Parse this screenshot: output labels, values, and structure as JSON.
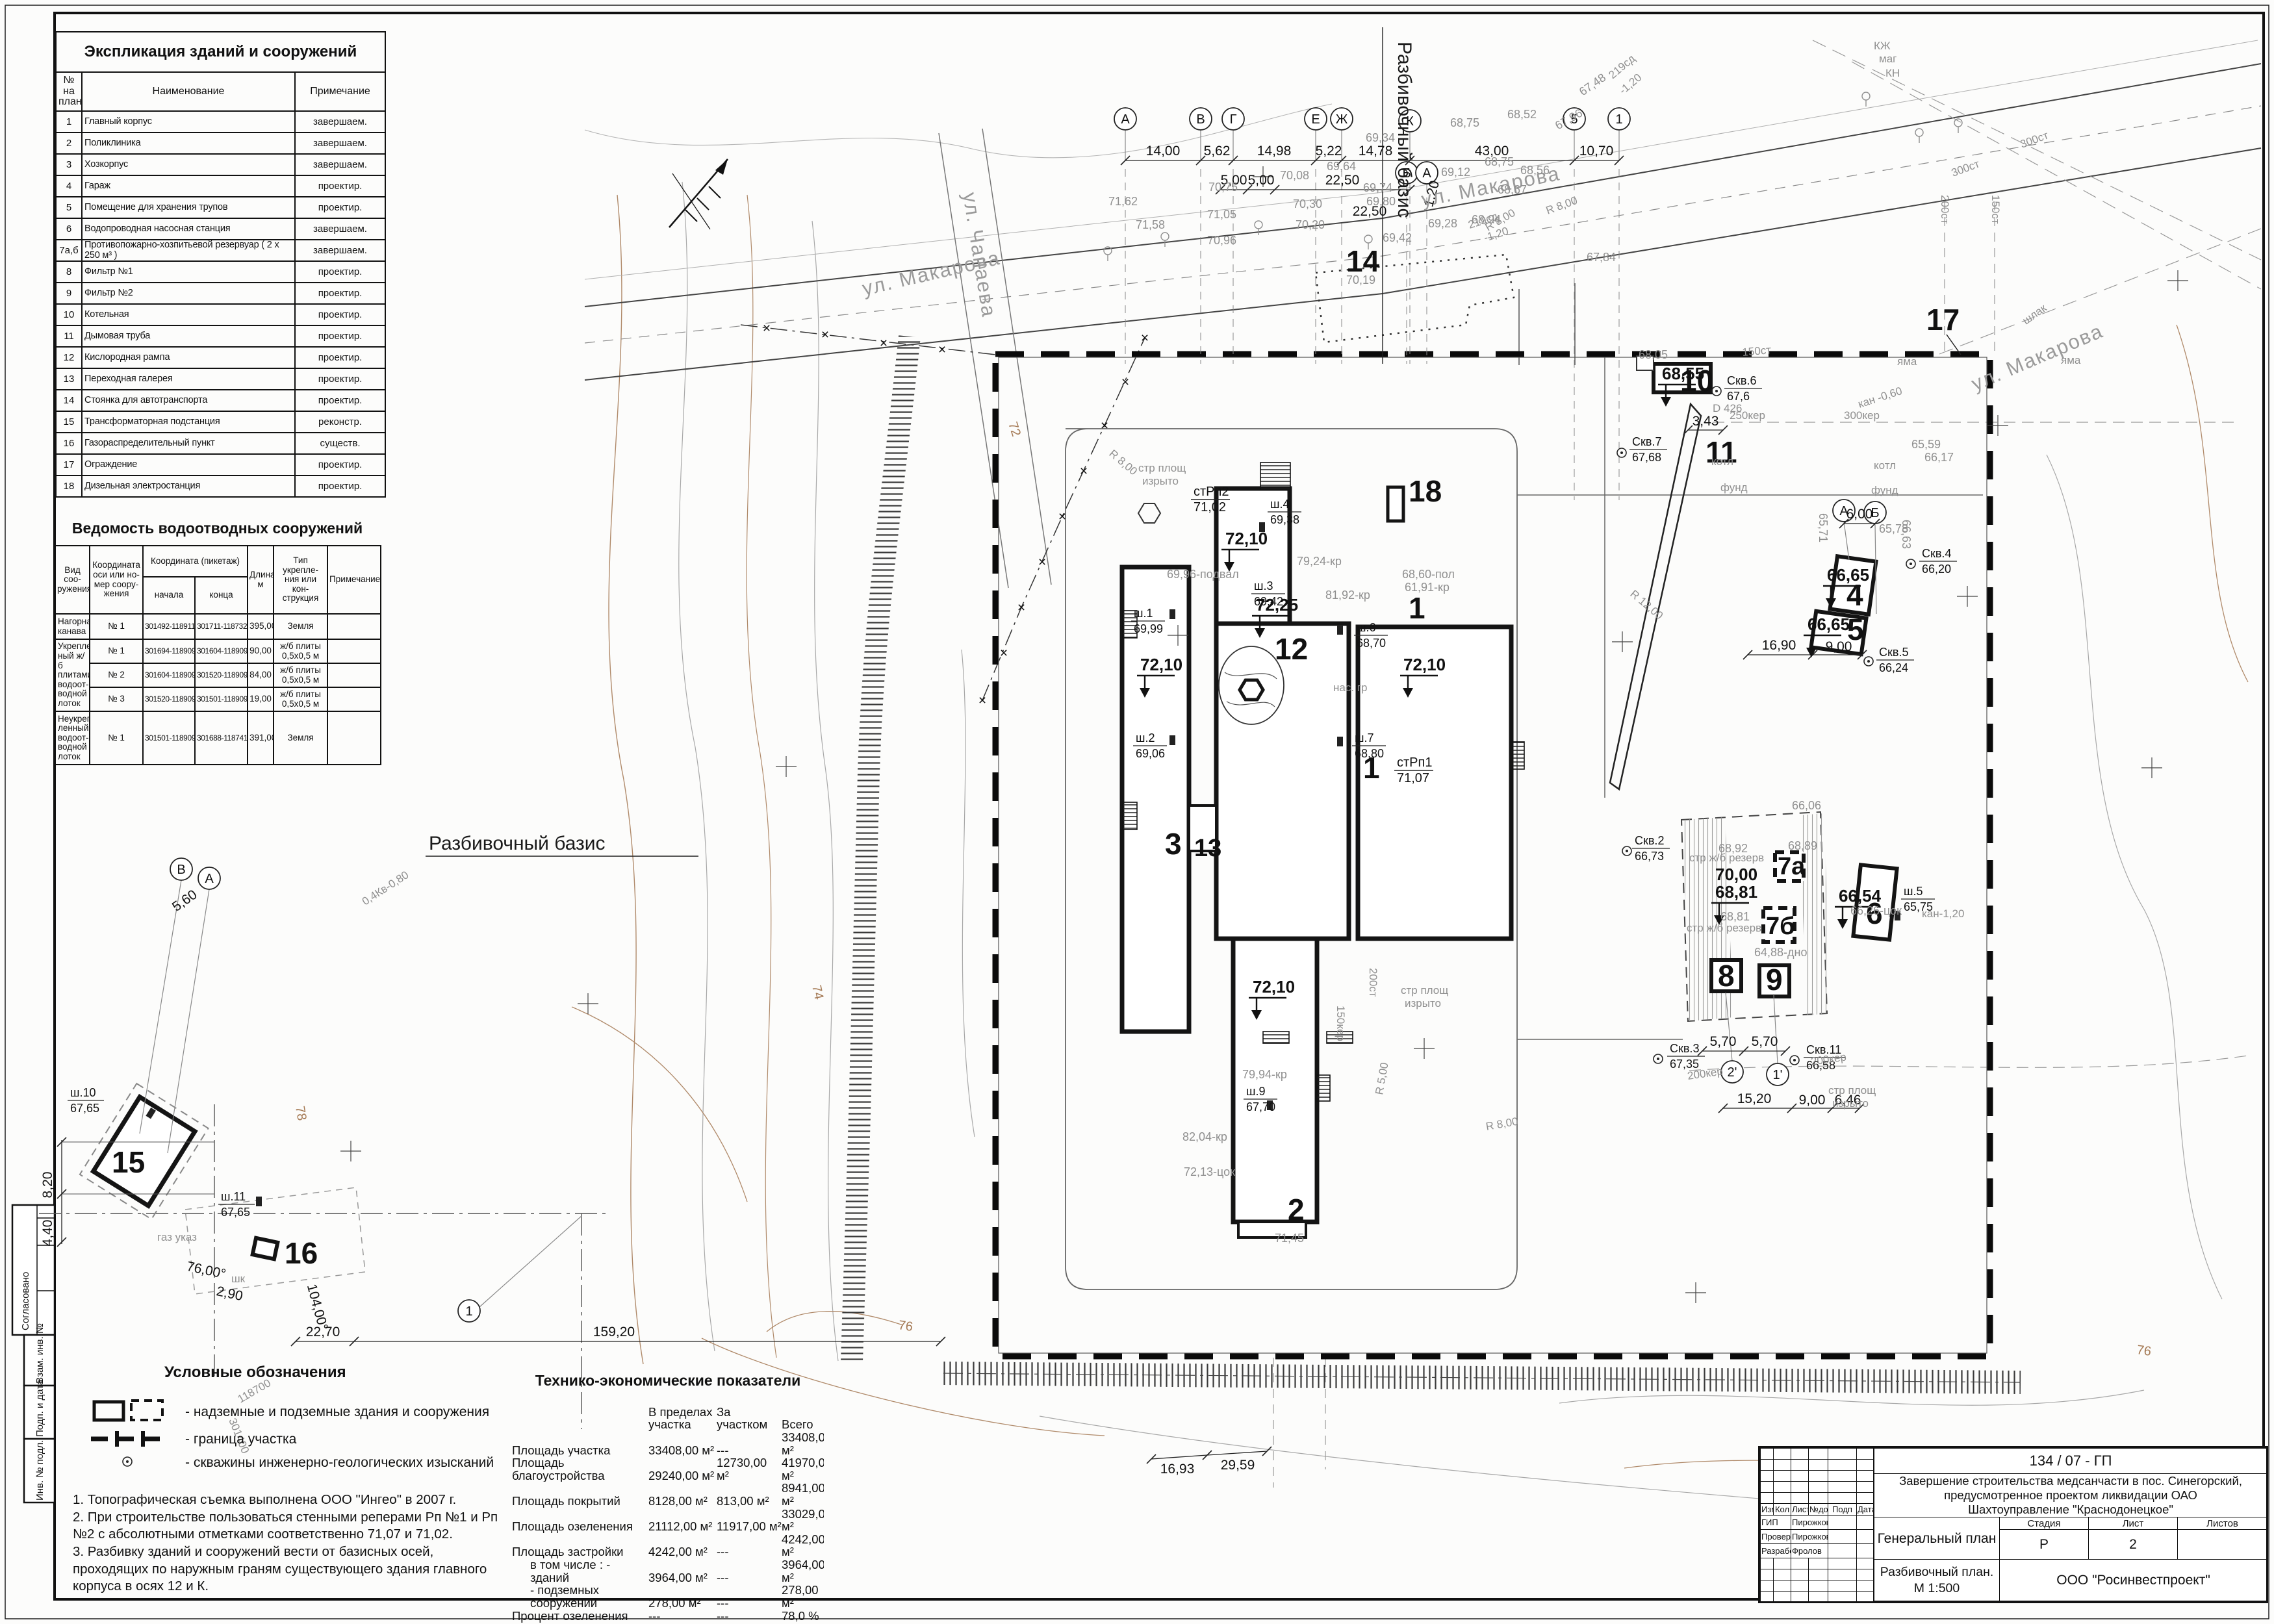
{
  "sheet": {
    "explication": {
      "title": "Экспликация зданий и сооружений",
      "columns": {
        "num": "№ на\nплане",
        "name": "Наименование",
        "note": "Примечание"
      },
      "rows": [
        {
          "n": "1",
          "name": "Главный корпус",
          "note": "завершаем."
        },
        {
          "n": "2",
          "name": "Поликлиника",
          "note": "завершаем."
        },
        {
          "n": "3",
          "name": "Хозкорпус",
          "note": "завершаем."
        },
        {
          "n": "4",
          "name": "Гараж",
          "note": "проектир."
        },
        {
          "n": "5",
          "name": "Помещение для хранения трупов",
          "note": "проектир."
        },
        {
          "n": "6",
          "name": "Водопроводная насосная станция",
          "note": "завершаем."
        },
        {
          "n": "7а,б",
          "name": "Противопожарно-хозпитьевой резервуар ( 2 х 250 м³ )",
          "note": "завершаем."
        },
        {
          "n": "8",
          "name": "Фильтр №1",
          "note": "проектир."
        },
        {
          "n": "9",
          "name": "Фильтр №2",
          "note": "проектир."
        },
        {
          "n": "10",
          "name": "Котельная",
          "note": "проектир."
        },
        {
          "n": "11",
          "name": "Дымовая труба",
          "note": "проектир."
        },
        {
          "n": "12",
          "name": "Кислородная рампа",
          "note": "проектир."
        },
        {
          "n": "13",
          "name": "Переходная галерея",
          "note": "проектир."
        },
        {
          "n": "14",
          "name": "Стоянка для автотранспорта",
          "note": "проектир."
        },
        {
          "n": "15",
          "name": "Трансформаторная подстанция",
          "note": "реконстр."
        },
        {
          "n": "16",
          "name": "Газораспределительный пункт",
          "note": "существ."
        },
        {
          "n": "17",
          "name": "Ограждение",
          "note": "проектир."
        },
        {
          "n": "18",
          "name": "Дизельная электростанция",
          "note": "проектир."
        }
      ]
    },
    "drainage": {
      "title": "Ведомость водоотводных сооружений",
      "columns": {
        "kind": "Вид соо-\nружения",
        "axis": "Координата\nоси или но-\nмер соору-\nжения",
        "coord": "Координата (пикетаж)",
        "start": "начала",
        "end": "конца",
        "len": "Длина,\nм",
        "type": "Тип укрепле-\nния или кон-\nструкция",
        "note": "Примечание"
      },
      "rows": [
        {
          "kind": "Нагорная\nканава",
          "axis": "№ 1",
          "start": "301492-118911",
          "end": "301711-118732",
          "len": "395,00",
          "type": "Земля",
          "note": ""
        },
        {
          "kind": "Укреплен-\nный ж/б\nплитами\nводоот-\nводной\nлоток",
          "axis": "№ 1",
          "start": "301694-118909",
          "end": "301604-118909",
          "len": "90,00",
          "type": "ж/б плиты\n0,5х0,5 м",
          "note": ""
        },
        {
          "axis": "№ 2",
          "start": "301604-118909",
          "end": "301520-118909",
          "len": "84,00",
          "type": "ж/б плиты\n0,5х0,5 м",
          "note": ""
        },
        {
          "axis": "№ 3",
          "start": "301520-118909",
          "end": "301501-118909",
          "len": "19,00",
          "type": "ж/б плиты\n0,5х0,5 м",
          "note": ""
        },
        {
          "kind": "Неукреп-\nленный\nводоот-\nводной\nлоток",
          "axis": "№ 1",
          "start": "301501-118909",
          "end": "301688-118741",
          "len": "391,00",
          "type": "Земля",
          "note": ""
        }
      ]
    },
    "legend": {
      "title": "Условные обозначения",
      "items": [
        "-  надземные и подземные здания и сооружения",
        "-  граница участка",
        "-  скважины инженерно-геологических изысканий"
      ]
    },
    "notes": {
      "n1": "1. Топографическая съемка выполнена ООО \"Ингео\" в 2007 г.",
      "n2": "2. При строительстве пользоваться стенными реперами Рп №1 и Рп №2 с абсолютными отметками соответственно 71,07 и 71,02.",
      "n3": "3. Разбивку зданий и сооружений вести от базисных осей, проходящих по наружным граням существующего здания главного корпуса в осях 12 и К."
    },
    "tep": {
      "title": "Технико-экономические показатели",
      "columns": {
        "c1": "В пределах\nучастка",
        "c2": "За участком",
        "c3": "Всего"
      },
      "rows": [
        {
          "label": "Площадь участка",
          "v1": "33408,00 м²",
          "v2": "---",
          "v3": "33408,00 м²"
        },
        {
          "label": "Площадь благоустройства",
          "v1": "29240,00 м²",
          "v2": "12730,00 м²",
          "v3": "41970,00 м²"
        },
        {
          "label": "Площадь покрытий",
          "v1": "8128,00 м²",
          "v2": "813,00 м²",
          "v3": "8941,00 м²"
        },
        {
          "label": "Площадь озеленения",
          "v1": "21112,00 м²",
          "v2": "11917,00 м²",
          "v3": "33029,00 м²"
        },
        {
          "label": "Площадь застройки",
          "v1": "4242,00 м²",
          "v2": "---",
          "v3": "4242,00 м²"
        },
        {
          "label": "в том числе : - зданий",
          "v1": "3964,00 м²",
          "v2": "---",
          "v3": "3964,00 м²"
        },
        {
          "label": "- подземных сооружений",
          "v1": "278,00 м²",
          "v2": "---",
          "v3": "278,00 м²"
        },
        {
          "label": "Процент озеленения",
          "v1": "---",
          "v2": "---",
          "v3": "78,0 %"
        }
      ]
    },
    "stamp": {
      "doc_number": "134 / 07 - ГП",
      "project": "Завершение строительства медсанчасти в пос. Синегорский,\nпредусмотренное проектом ликвидации ОАО\nШахтоуправление \"Краснодонецкое\"",
      "h_izm": "Изм",
      "h_kol": "Кол",
      "h_list": "Лист",
      "h_ndok": "№док",
      "h_podp": "Подп",
      "h_data": "Дата",
      "gip_label": "ГИП",
      "gip_name": "Пирожкова",
      "check_label": "Проверил",
      "check_name": "Пирожкова",
      "dev_label": "Разработ.",
      "dev_name": "Фролов",
      "drawing_title": "Генеральный план",
      "stage_label": "Стадия",
      "sheet_label": "Лист",
      "sheets_label": "Листов",
      "stage": "Р",
      "sheet_num": "2",
      "sheets_total": "",
      "subtitle": "Разбивочный план.\nМ 1:500",
      "company": "ООО \"Росинвестпроект\""
    },
    "side_stamp": {
      "s1": "Согласовано",
      "s2": "Взам. инв. №",
      "s3": "Подп. и дата",
      "s4": "Инв. № подл."
    }
  },
  "plan": {
    "labels": {
      "num1": "1",
      "num1b": "1",
      "num2": "2",
      "num3": "3",
      "num13": "13",
      "num12": "12",
      "num14": "14",
      "num10": "10",
      "num11": "11",
      "num18": "18",
      "num4": "4",
      "num5": "5",
      "num6": "6",
      "num7a": "7а",
      "num7b": "7б",
      "num8": "8",
      "num9": "9",
      "num15": "15",
      "num16": "16",
      "num17": "17",
      "e1": "72,10",
      "e2": "72,10",
      "e3": "72,10",
      "e4": "72,25",
      "e5": "72,10",
      "e6": "68,55",
      "e7": "66,65",
      "e8": "66,65",
      "e9": "66,54",
      "e10": "70,00",
      "e11": "68,81",
      "bm1a": "стРп2",
      "bm1b": "71,02",
      "bm2a": "стРп1",
      "bm2b": "71,07",
      "sh1a": "ш.1",
      "sh1b": "69,99",
      "sh2a": "ш.2",
      "sh2b": "69,06",
      "sh3a": "ш.3",
      "sh3b": "69,42",
      "sh4a": "ш.4",
      "sh4b": "69,38",
      "sh5a": "ш.5",
      "sh5b": "65,75",
      "sh6a": "ш.6",
      "sh6b": "68,70",
      "sh7a": "ш.7",
      "sh7b": "68,80",
      "sh9a": "ш.9",
      "sh9b": "67,70",
      "sh10a": "ш.10",
      "sh10b": "67,65",
      "sh11a": "ш.11",
      "sh11b": "67,65",
      "skv2a": "Скв.2",
      "skv2b": "66,73",
      "skv3a": "Скв.3",
      "skv3b": "67,35",
      "skv4a": "Скв.4",
      "skv4b": "66,20",
      "skv5a": "Скв.5",
      "skv5b": "66,24",
      "skv6a": "Скв.6",
      "skv6b": "67,6",
      "skv7a": "Скв.7",
      "skv7b": "67,68",
      "skv11a": "Скв.11",
      "skv11b": "66,58",
      "d1": "14,00",
      "d2": "5,62",
      "d3": "14,98",
      "d4": "5,22",
      "d5": "14,78",
      "d6": "43,00",
      "d7": "10,70",
      "d8": "5,00",
      "d9": "5,00",
      "d10": "22,50",
      "d11": "1,20",
      "d12": "22,50",
      "d13": "5,60",
      "d14": "8,20",
      "d15": "4,40",
      "d16": "159,20",
      "d17": "22,70",
      "d18": "16,93",
      "d19": "29,59",
      "d20": "5,70",
      "d21": "5,70",
      "d22": "15,20",
      "d23": "9,00",
      "d24": "6,46",
      "d25": "16,90",
      "d26": "9,00",
      "d27": "6,00",
      "d28": "3,43",
      "d29": "2,90",
      "d30": "76,00°",
      "d31": "104,00°",
      "st1": "ул. Макарова",
      "st2": "ул. Макарова",
      "st3": "ул. Макарова",
      "st4": "ул. Чапаева",
      "basisV": "Разбивочный базис",
      "basisH": "Разбивочный базис",
      "c74": "74",
      "c76a": "76",
      "c72": "72",
      "c78": "78",
      "c76b": "76",
      "sp1": "68,75",
      "sp2": "68,52",
      "sp3": "69,34",
      "sp4": "68,75",
      "sp5": "68,56",
      "sp6": "69,12",
      "sp7": "68,67",
      "sp8": "68,94",
      "sp9": "69,28",
      "sp10": "69,42",
      "sp11": "69,74",
      "sp12": "69,80",
      "sp13": "70,08",
      "sp14": "70,30",
      "sp15": "70,20",
      "sp16": "70,75",
      "sp17": "71,62",
      "sp18": "71,58",
      "sp19": "71,05",
      "sp20": "70,96",
      "sp21": "67,84",
      "sp22": "67,48",
      "sp23": "69,64",
      "sp24": "68,92",
      "sp25": "68,89",
      "sp26": "68,81",
      "sp27": "66,06",
      "sp28": "65,59",
      "sp29": "66,17",
      "sp30": "65,78",
      "sp31": "68,05",
      "sp32": "70,19",
      "sp33": "68,60-пол",
      "sp34": "61,91-кр",
      "sp35": "81,92-кр",
      "sp36": "79,24-кр",
      "sp37": "79,94-кр",
      "sp38": "82,04-кр",
      "sp39": "72,13-цок",
      "sp40": "71,45",
      "sp41": "64,88-дно",
      "sp42": "66,26-цок",
      "sp43": "69,96-подвал",
      "sp44": "65,71",
      "sp45": "66,63",
      "sp46": "67,96",
      "u1": "300ст",
      "u2": "300ст",
      "u3": "200ст",
      "u4": "150ст",
      "u5": "шлак",
      "u6": "250кер",
      "u7": "300кер",
      "u8": "200кер",
      "u9": "200кер",
      "u10": "150кер",
      "u11": "200ст",
      "u12": "150ст",
      "u13": "кан -0,60",
      "u14": "кан-1,20",
      "u15": "яма",
      "u16": "яма",
      "u17a": "стр площ",
      "u17b": "изрыто",
      "u18a": "стр площ",
      "u18b": "изрыто",
      "u19a": "стр площ",
      "u19b": "изрыто",
      "u20": "стр ж/б резерв",
      "u21": "стр ж/б резерв",
      "u22": "котл",
      "u23": "фунд",
      "u24": "котл",
      "u25": "фунд",
      "u26": "нас. гр",
      "u27": "R 8,00",
      "u28": "R 8,00",
      "u29": "R 8,00",
      "u30": "R 12,00",
      "u31": "R 5,00",
      "u32": "R 8,00",
      "u33": "D 426",
      "u34a": "КЖ",
      "u34b": "маг",
      "u35": "КН",
      "u36": "газ указ",
      "u37": "шк",
      "u38": "0,4Кв-0,80",
      "u39": "219сд",
      "u40": "-1,20",
      "u41": "219сд",
      "u42": "-1,20",
      "u43": "118700",
      "u44": "301400",
      "ax1": "А",
      "ax2": "В",
      "ax3": "Г",
      "ax4": "Е",
      "ax5": "Ж",
      "ax6": "К",
      "ax7": "5",
      "ax8": "1",
      "ax9": "Б",
      "ax10": "А",
      "ax11": "В",
      "ax12": "А",
      "ax13": "2'",
      "ax14": "1'",
      "ax15": "А",
      "ax16": "Б",
      "ax17": "1"
    }
  }
}
